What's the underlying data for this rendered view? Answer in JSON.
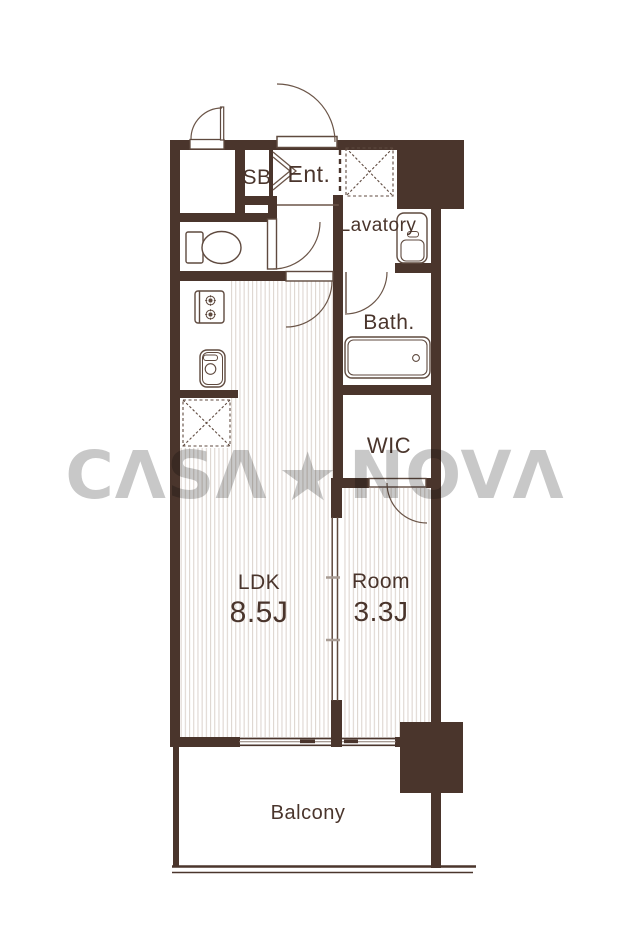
{
  "watermark": {
    "text_left": "CΛSΛ",
    "star": "★",
    "text_right": "NOVΛ"
  },
  "rooms": {
    "sb": {
      "label": "SB"
    },
    "ent": {
      "label": "Ent."
    },
    "lavatory": {
      "label": "Lavatory"
    },
    "bath": {
      "label": "Bath."
    },
    "wic": {
      "label": "WIC"
    },
    "ldk": {
      "label": "LDK",
      "area": "8.5J"
    },
    "room": {
      "label": "Room",
      "area": "3.3J"
    },
    "balcony": {
      "label": "Balcony"
    }
  },
  "fixtures": [
    "toilet",
    "kitchen-stove",
    "kitchen-sink",
    "refrigerator-space",
    "washing-machine-space",
    "bathtub",
    "vanity-sink",
    "entrance-door",
    "sliding-partition",
    "sliding-window",
    "balcony-pillar"
  ],
  "colors": {
    "wall": "#4a352c",
    "fixture_line": "#5f4a3f",
    "arc_line": "#6b5548",
    "floor_stripe": "#ded6d0",
    "label_text": "#4a352c",
    "watermark_gray": "#c8c8c8"
  }
}
